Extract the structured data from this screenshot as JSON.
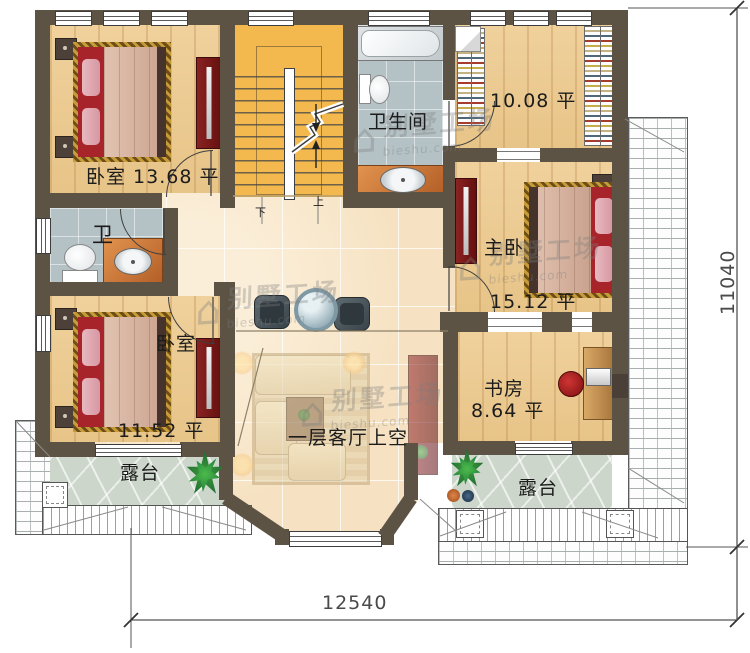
{
  "colors": {
    "wall": "#5d5345",
    "stairs": "#f3b94e",
    "wood": "#eccd96",
    "corridor": "#f8e7cb",
    "bath_tile": "#b4c2c6",
    "flagstone": "#ccd6ca",
    "accent_red": "#7c1e1e",
    "label": "#1c1c1c",
    "dim": "#4a4a4a"
  },
  "rooms": {
    "bedroom_top_left": {
      "label": "卧室 13.68 平"
    },
    "closet": {
      "area": "10.08 平"
    },
    "bathroom": {
      "name": "卫生间"
    },
    "master": {
      "name": "主卧",
      "area": "15.12 平"
    },
    "study": {
      "name": "书房",
      "area": "8.64 平"
    },
    "toilet": {
      "name": "卫"
    },
    "bedroom_bottom_left": {
      "name": "卧室",
      "area": "11.52 平"
    },
    "void": {
      "label": "一层客厅上空"
    },
    "terrace_left": {
      "label": "露台"
    },
    "terrace_right": {
      "label": "露台"
    }
  },
  "stairs": {
    "up": "上",
    "down": "下"
  },
  "dimensions": {
    "width": "12540",
    "height": "11040"
  },
  "watermark": {
    "logo_glyph": "⌂",
    "brand": "别墅工场",
    "domain": "bieshu.com"
  }
}
